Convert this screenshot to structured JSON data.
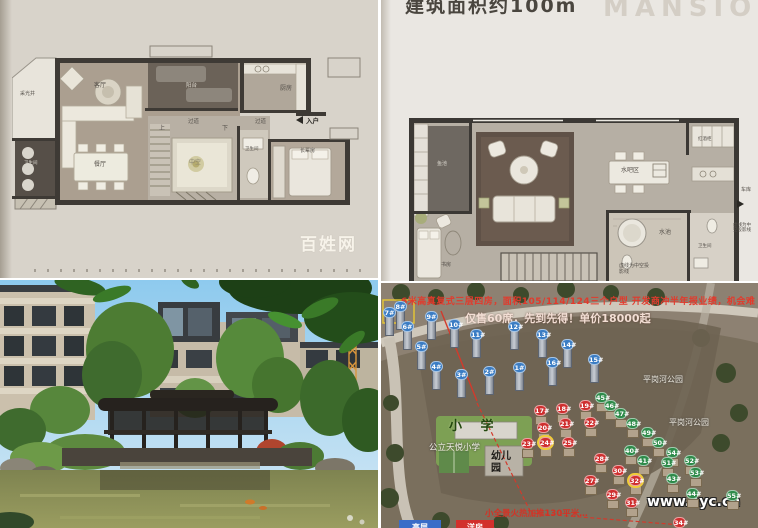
{
  "tl": {
    "labels": {
      "light_well": "采光井",
      "living": "客厅",
      "deck": "阳台",
      "kitchen": "厨房",
      "entry": "入户",
      "entry_arrow": "◀",
      "hall1": "过道",
      "hall2": "过道",
      "up": "上",
      "down": "下",
      "void": "中空",
      "bath": "卫生间",
      "bath2": "卫生间",
      "elder_room": "长辈房",
      "dining": "餐厅"
    },
    "watermark": "百姓网"
  },
  "tr": {
    "header": "建筑面积约100m",
    "watermark": "MANSION",
    "labels": {
      "fish_pond": "鱼池",
      "bar": "水吧区",
      "wine_cabinet": "红酒柜",
      "garage": "车库",
      "garage_arrow": "▶",
      "pool": "水池",
      "bath": "卫生间",
      "study": "书房",
      "note": "虚线为中空投影线"
    }
  },
  "br": {
    "promo_line1": "6米高真复式三层四房，面积105/114/124三个户型 开发商冲半年报业绩，机会难",
    "promo_line2": "仅售60席，先到先得！单价18000起",
    "bottom_promo": "小全景火热加推130平米…",
    "watermark": "www.ayc.cn",
    "school_area": "小 学",
    "school_name": "公立天悦小学",
    "kindergarten": "幼儿园",
    "park1": "平岗河公园",
    "park2": "平岗河公园",
    "tab_blue": "高层",
    "tab_red": "洋房",
    "tab_blue_color": "#3a6cc8",
    "tab_red_color": "#d2302c",
    "marker_colors": {
      "blue": "#3b7dc4",
      "red": "#cf2f2f",
      "green": "#2e8b4a"
    },
    "markers": [
      {
        "n": "7#",
        "c": "blue",
        "x": 8,
        "y": 29
      },
      {
        "n": "8#",
        "c": "blue",
        "x": 19,
        "y": 23
      },
      {
        "n": "9#",
        "c": "blue",
        "x": 50,
        "y": 33
      },
      {
        "n": "6#",
        "c": "blue",
        "x": 26,
        "y": 43
      },
      {
        "n": "10#",
        "c": "blue",
        "x": 73,
        "y": 41
      },
      {
        "n": "5#",
        "c": "blue",
        "x": 40,
        "y": 63
      },
      {
        "n": "11#",
        "c": "blue",
        "x": 95,
        "y": 51
      },
      {
        "n": "12#",
        "c": "blue",
        "x": 133,
        "y": 43
      },
      {
        "n": "13#",
        "c": "blue",
        "x": 161,
        "y": 51
      },
      {
        "n": "14#",
        "c": "blue",
        "x": 186,
        "y": 61
      },
      {
        "n": "4#",
        "c": "blue",
        "x": 55,
        "y": 83
      },
      {
        "n": "3#",
        "c": "blue",
        "x": 80,
        "y": 91
      },
      {
        "n": "2#",
        "c": "blue",
        "x": 108,
        "y": 88
      },
      {
        "n": "1#",
        "c": "blue",
        "x": 138,
        "y": 84
      },
      {
        "n": "16#",
        "c": "blue",
        "x": 171,
        "y": 79
      },
      {
        "n": "15#",
        "c": "blue",
        "x": 213,
        "y": 76
      },
      {
        "n": "17#",
        "c": "red",
        "x": 159,
        "y": 127
      },
      {
        "n": "18#",
        "c": "red",
        "x": 181,
        "y": 125
      },
      {
        "n": "19#",
        "c": "red",
        "x": 204,
        "y": 122
      },
      {
        "n": "20#",
        "c": "red",
        "x": 162,
        "y": 144
      },
      {
        "n": "21#",
        "c": "red",
        "x": 184,
        "y": 140
      },
      {
        "n": "22#",
        "c": "red",
        "x": 209,
        "y": 139
      },
      {
        "n": "23#",
        "c": "red",
        "x": 146,
        "y": 160
      },
      {
        "n": "24#",
        "c": "red",
        "x": 164,
        "y": 159,
        "boxed": true
      },
      {
        "n": "25#",
        "c": "red",
        "x": 187,
        "y": 159
      },
      {
        "n": "28#",
        "c": "red",
        "x": 219,
        "y": 175
      },
      {
        "n": "27#",
        "c": "red",
        "x": 209,
        "y": 197
      },
      {
        "n": "30#",
        "c": "red",
        "x": 237,
        "y": 187
      },
      {
        "n": "32#",
        "c": "red",
        "x": 254,
        "y": 197,
        "boxed": true
      },
      {
        "n": "29#",
        "c": "red",
        "x": 231,
        "y": 211
      },
      {
        "n": "31#",
        "c": "red",
        "x": 250,
        "y": 219
      },
      {
        "n": "34#",
        "c": "red",
        "x": 298,
        "y": 239
      },
      {
        "n": "45#",
        "c": "green",
        "x": 220,
        "y": 114
      },
      {
        "n": "46#",
        "c": "green",
        "x": 229,
        "y": 122
      },
      {
        "n": "47#",
        "c": "green",
        "x": 239,
        "y": 130
      },
      {
        "n": "48#",
        "c": "green",
        "x": 251,
        "y": 140
      },
      {
        "n": "49#",
        "c": "green",
        "x": 266,
        "y": 149
      },
      {
        "n": "50#",
        "c": "green",
        "x": 277,
        "y": 159
      },
      {
        "n": "40#",
        "c": "green",
        "x": 249,
        "y": 167
      },
      {
        "n": "41#",
        "c": "green",
        "x": 262,
        "y": 177
      },
      {
        "n": "54#",
        "c": "green",
        "x": 291,
        "y": 169
      },
      {
        "n": "51#",
        "c": "green",
        "x": 286,
        "y": 179
      },
      {
        "n": "52#",
        "c": "green",
        "x": 309,
        "y": 177
      },
      {
        "n": "53#",
        "c": "green",
        "x": 314,
        "y": 189
      },
      {
        "n": "43#",
        "c": "green",
        "x": 291,
        "y": 195
      },
      {
        "n": "44#",
        "c": "green",
        "x": 311,
        "y": 210
      },
      {
        "n": "55#",
        "c": "green",
        "x": 351,
        "y": 212
      }
    ]
  }
}
